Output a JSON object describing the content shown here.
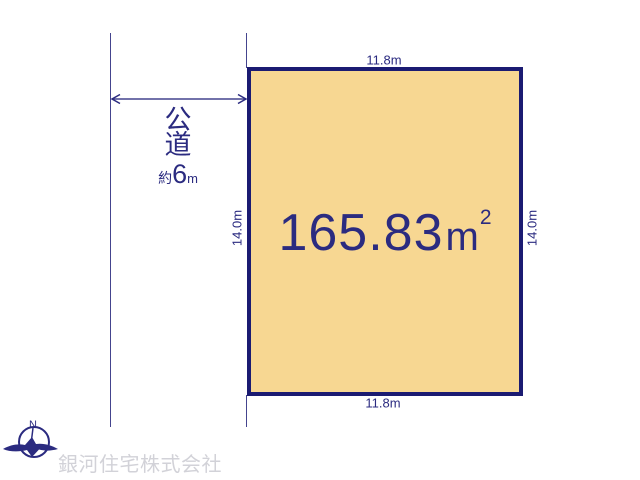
{
  "plot": {
    "area_value": "165.83",
    "area_unit_base": "m",
    "area_unit_exponent": "2",
    "top_dim": "11.8m",
    "bottom_dim": "11.8m",
    "left_dim": "14.0m",
    "right_dim": "14.0m"
  },
  "road": {
    "label_char1": "公",
    "label_char2": "道",
    "width_prefix": "約",
    "width_value": "6",
    "width_unit": "m"
  },
  "compass": {
    "north_label": "N"
  },
  "footer": {
    "company_name": "銀河住宅株式会社"
  },
  "colors": {
    "navy_dark": "#1b1b72",
    "navy_text": "#2b2b80",
    "line_slate": "#44448e",
    "plot_fill": "#f7d792",
    "company_gray": "#d2d2d8"
  }
}
